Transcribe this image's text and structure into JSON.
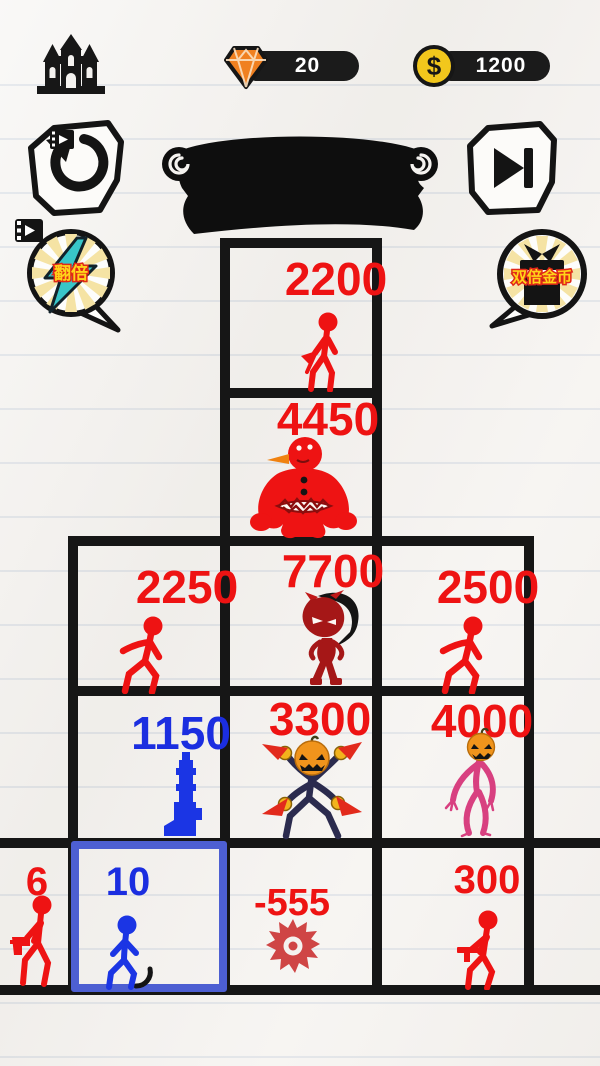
{
  "header": {
    "gems": "20",
    "coins": "1200"
  },
  "bubbles": {
    "double_power": {
      "label": "翻倍"
    },
    "double_coins": {
      "label": "双倍金币"
    }
  },
  "colors": {
    "enemy_red": "#ee1313",
    "ally_blue": "#1b2ee0",
    "selected_cell_border": "#4d5fd2",
    "grid_ink": "#161616",
    "paper": "#f4f2ef",
    "gem_orange": "#f08020",
    "coin_yellow": "#f2c71c",
    "bolt_teal": "#38c6c9",
    "pumpkin_orange": "#f0941c",
    "pink_figure": "#d84080"
  },
  "grid": {
    "cells": [
      {
        "value": "2200",
        "color": "red",
        "figure": "axe-stickman"
      },
      {
        "value": "4450",
        "color": "red",
        "figure": "belly-monster"
      },
      {
        "value": "2250",
        "color": "red",
        "figure": "walking-stickman"
      },
      {
        "value": "7700",
        "color": "red",
        "figure": "hooded-devil"
      },
      {
        "value": "2500",
        "color": "red",
        "figure": "walking-stickman"
      },
      {
        "value": "1150",
        "color": "blue",
        "figure": "standing-gun"
      },
      {
        "value": "3300",
        "color": "red",
        "figure": "pumpkin-blade-fighter"
      },
      {
        "value": "4000",
        "color": "red",
        "figure": "pink-pumpkin-stickman"
      },
      {
        "value": "6",
        "color": "red",
        "figure": "gun-stickman",
        "selected": false
      },
      {
        "value": "10",
        "color": "blue",
        "figure": "walking-stickman",
        "selected": true
      },
      {
        "value": "-555",
        "color": "red",
        "figure": "saw-blade"
      },
      {
        "value": "300",
        "color": "red",
        "figure": "gun-stickman"
      },
      {
        "value": "",
        "color": "none",
        "figure": ""
      }
    ]
  }
}
